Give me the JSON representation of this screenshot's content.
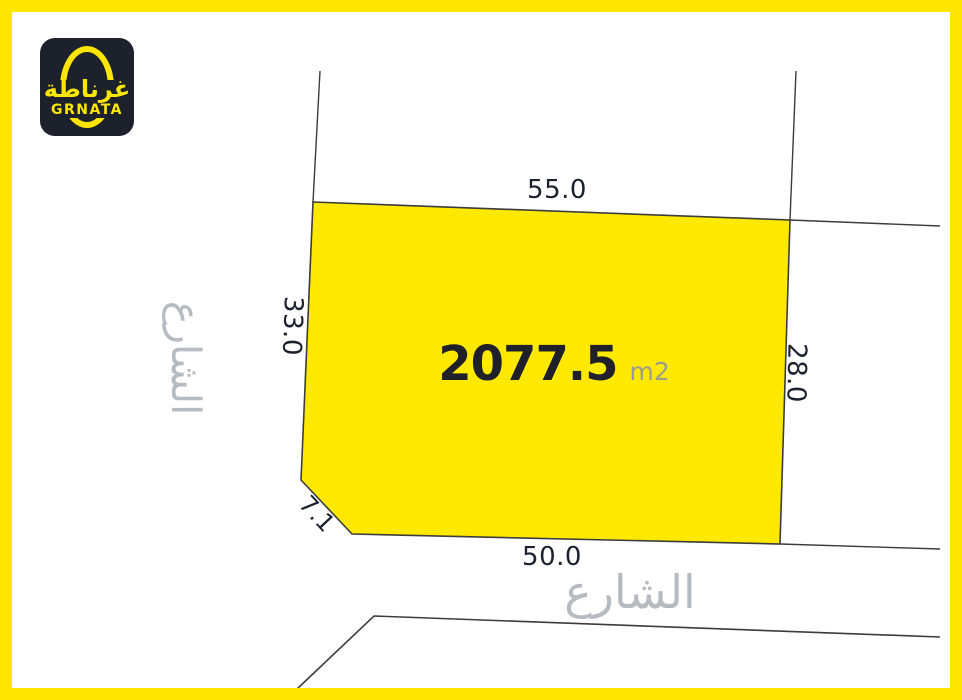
{
  "brand": {
    "name": "GRNATA",
    "arabic_name": "غرناطة"
  },
  "colors": {
    "frame_yellow": "#FFE600",
    "plot_fill": "#FFE900",
    "plot_stroke": "#3C3C3C",
    "line": "#3C3C3C",
    "dimension_text": "#1C2130",
    "area_text": "#20202A",
    "unit_text": "#9B9B90",
    "street_text": "#B6BBC2",
    "logo_bg": "#1C212B"
  },
  "plot": {
    "area_value": "2077.5",
    "area_unit": "m2",
    "dimensions": {
      "top": "55.0",
      "left": "33.0",
      "right": "28.0",
      "bottom": "50.0",
      "corner": "7.1"
    }
  },
  "streets": {
    "left": "الشارع",
    "bottom": "الشارع"
  }
}
